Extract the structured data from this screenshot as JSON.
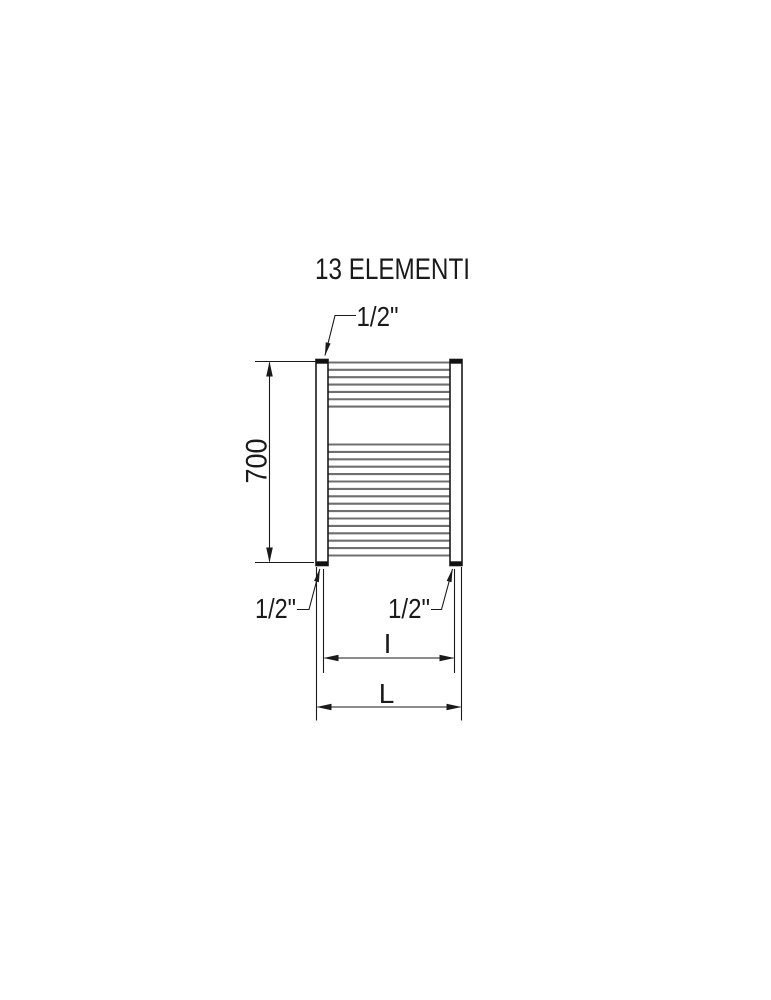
{
  "title": "13 ELEMENTI",
  "labels": {
    "top_connection": "1/2\"",
    "bottom_left_connection": "1/2\"",
    "bottom_right_connection": "1/2\"",
    "height": "700",
    "interaxis": "I",
    "overall_width": "L"
  },
  "radiator": {
    "element_groups": [
      {
        "name": "top-group",
        "tube_count": 7
      },
      {
        "name": "bottom-group",
        "tube_count": 16
      }
    ]
  },
  "colors": {
    "line": "#1a1a1a",
    "tube": "#6f6f6f",
    "background": "#ffffff"
  }
}
